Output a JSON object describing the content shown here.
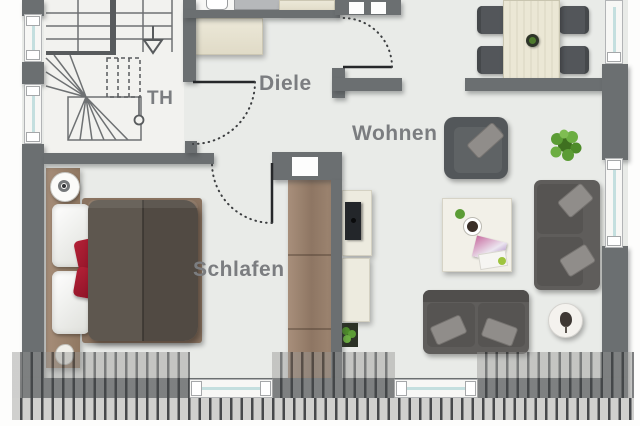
{
  "rooms": [
    {
      "id": "th",
      "label": "TH"
    },
    {
      "id": "diele",
      "label": "Diele"
    },
    {
      "id": "wohnen",
      "label": "Wohnen"
    },
    {
      "id": "schlafen",
      "label": "Schlafen"
    }
  ],
  "furniture_icons": [
    "staircase-icon",
    "stair-direction-arrow-icon",
    "wardrobe-icon",
    "washbasin-icon",
    "shower-icon",
    "dining-table-icon",
    "dining-chair-icon",
    "potted-plant-icon",
    "armchair-icon",
    "coffee-table-icon",
    "cup-icon",
    "magazines-icon",
    "sofa-icon",
    "side-table-lamp-icon",
    "tv-lowboard-icon",
    "tv-icon",
    "bed-icon",
    "pillow-icon",
    "nightstand-lamp-icon",
    "tall-cupboard-icon",
    "window-icon",
    "door-swing-icon",
    "roof-hatching-icon",
    "shaft-icon"
  ],
  "colors": {
    "wall": "#6b6f71",
    "floor": "#e9ebe8",
    "stair_floor": "#f2f2ef",
    "label_text": "#7b7d80",
    "accent_red_pillow": "#a81e30",
    "wood_dark": "#9c8570",
    "wood_cream": "#e9e5d3",
    "duvet_dark": "#57504a",
    "sofa_gray": "#5f5d5b",
    "window_glass": "#c4dfdf",
    "plant_green": "#5b9c35",
    "roof_stripe_light": "#d0d0ce",
    "roof_stripe_dark": "#46484b"
  }
}
